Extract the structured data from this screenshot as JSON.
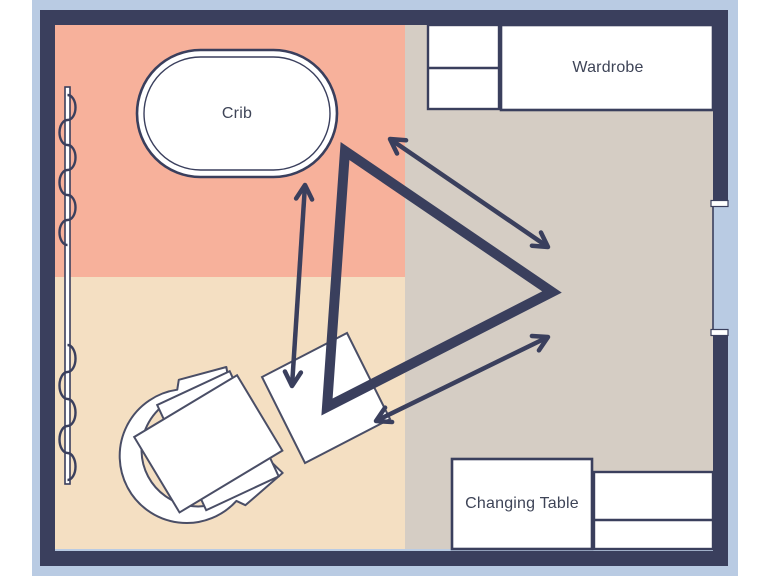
{
  "page": {
    "description": "Nursery room floor plan with a movement triangle connecting crib, nursing chair and changing area"
  },
  "labels": {
    "crib": "Crib",
    "wardrobe": "Wardrobe",
    "changing_table": "Changing Table"
  },
  "colors": {
    "surround_blue": "#b9cbe3",
    "wall_navy": "#3a3f5d",
    "zone_crib_salmon": "#f7b19b",
    "zone_chair_beige": "#f4dfc2",
    "zone_storage_taupe": "#d5cdc4",
    "furniture_white": "#ffffff",
    "furniture_outline": "#4a4e66",
    "label_text": "#3e4457"
  },
  "floor_plan": {
    "zones": [
      {
        "name": "crib-zone",
        "position": "top-left",
        "color_key": "zone_crib_salmon"
      },
      {
        "name": "nursing-chair-zone",
        "position": "bottom-left",
        "color_key": "zone_chair_beige"
      },
      {
        "name": "storage-zone",
        "position": "right",
        "color_key": "zone_storage_taupe"
      }
    ],
    "furniture": [
      {
        "name": "crib",
        "label_key": "crib",
        "shape": "stadium",
        "zone": "top-left"
      },
      {
        "name": "dresser",
        "shape": "two-compartment-rect",
        "zone": "top"
      },
      {
        "name": "wardrobe",
        "label_key": "wardrobe",
        "shape": "rect",
        "zone": "top-right"
      },
      {
        "name": "armchair",
        "shape": "rounded-armchair",
        "zone": "bottom-left"
      },
      {
        "name": "ottoman",
        "shape": "rotated-square",
        "zone": "bottom-center"
      },
      {
        "name": "changing-table",
        "label_key": "changing_table",
        "shape": "rect",
        "zone": "bottom-right"
      },
      {
        "name": "storage-unit",
        "shape": "two-compartment-rect",
        "zone": "bottom-right"
      }
    ],
    "door": {
      "wall": "right",
      "type": "opening-with-jambs"
    },
    "curtain": {
      "wall": "left",
      "symbol": "rod-with-wavy-line"
    },
    "annotations": {
      "movement_triangle": {
        "vertices": [
          "crib-corner",
          "ottoman-corner",
          "door-corner"
        ]
      },
      "movement_arrows": [
        "crib-to-ottoman",
        "crib-to-door",
        "ottoman-to-door"
      ]
    }
  }
}
